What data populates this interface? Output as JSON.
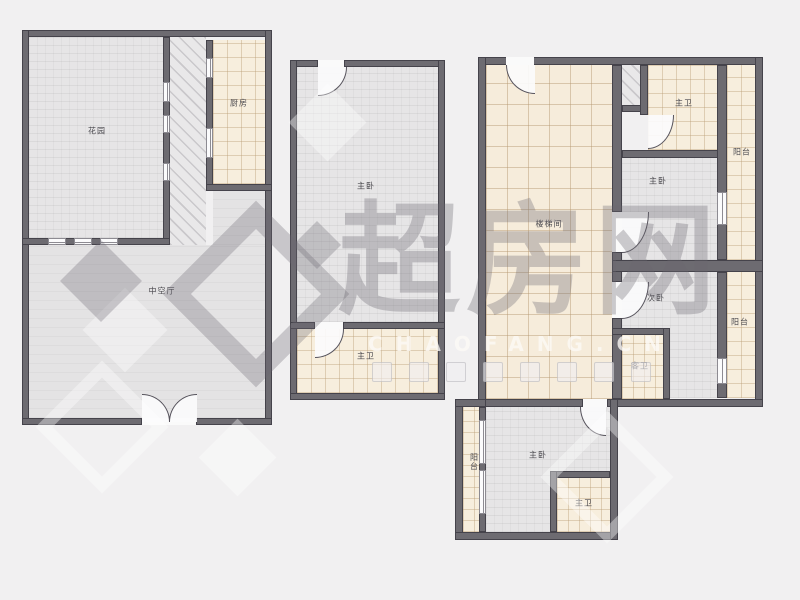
{
  "floorplans": {
    "plan1": {
      "rooms": {
        "garden": "花园",
        "kitchen": "厨房",
        "hall": "中空厅"
      }
    },
    "plan2": {
      "rooms": {
        "master_bedroom": "主卧",
        "master_bath": "主卫"
      }
    },
    "plan3": {
      "rooms": {
        "stairwell": "楼梯间",
        "master_bath_top": "主卫",
        "master_bedroom_mid": "主卧",
        "balcony_top": "阳台",
        "second_bedroom": "次卧",
        "guest_bath": "客卫",
        "balcony_mid": "阳台",
        "balcony_bottom": "阳台",
        "master_bedroom_bottom": "主卧",
        "master_bath_bottom": "主卫"
      }
    }
  },
  "watermark": {
    "brand": "超房网",
    "url": "CHAOFANG.CN"
  },
  "colors": {
    "background": "#f1f0f1",
    "wall": "#6d6b71",
    "tile_cream": "#f7eedd",
    "floor_gray": "#e6e5e6",
    "watermark_gray": "rgba(106,103,113,0.33)"
  }
}
